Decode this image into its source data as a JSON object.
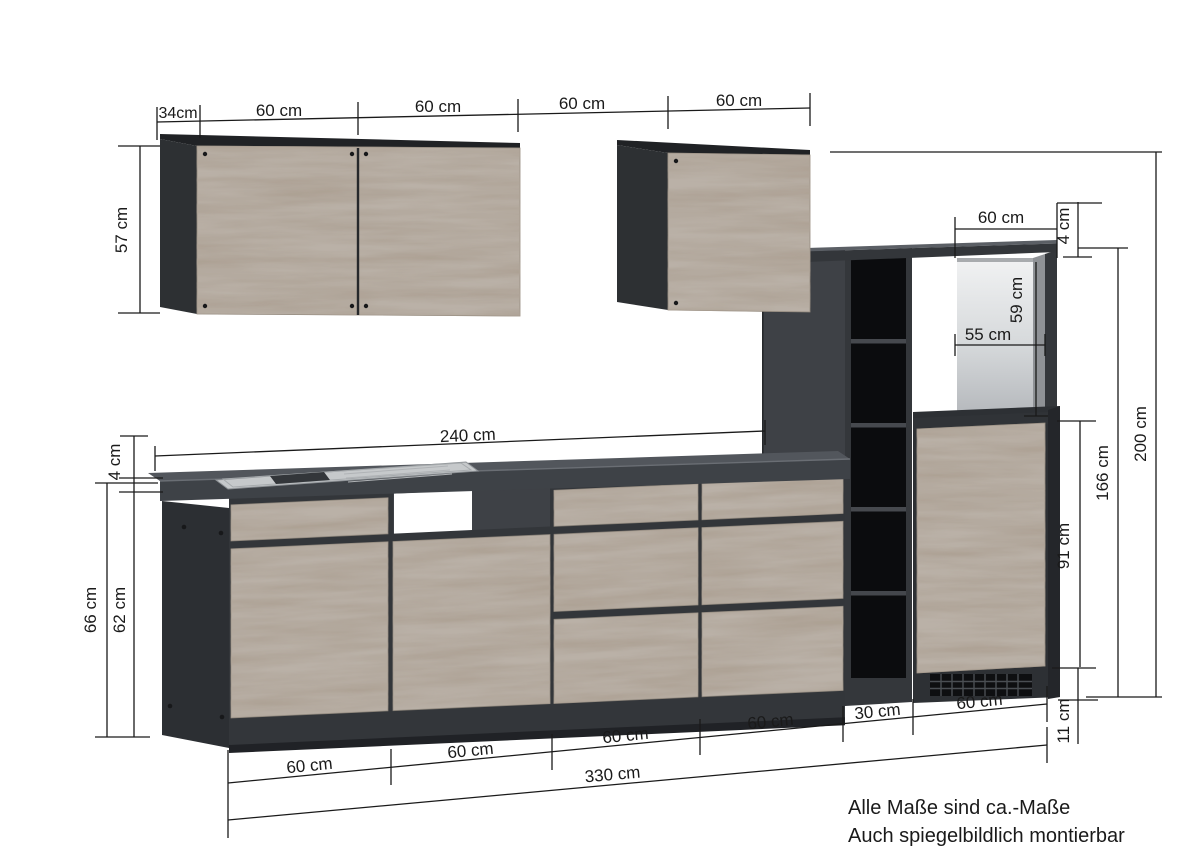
{
  "drawing": {
    "type": "kitchen-cabinet-dimension-diagram",
    "colors": {
      "background": "#ffffff",
      "wood": "#bab1a7",
      "wood_grain": "#6b5c4d",
      "carcass_dark": "#2d3033",
      "front_dark": "#3e4146",
      "counter_top": "#4f5257",
      "counter_front": "#3e4247",
      "shelf_interior": "#0b0c0e",
      "niche_light": "#eff0f1",
      "dimension_lines": "#1a1a1a"
    }
  },
  "dims": {
    "top": [
      "34cm",
      "60 cm",
      "60 cm",
      "60 cm",
      "60 cm"
    ],
    "wall_cabinet_height": "57 cm",
    "worktop_thickness": "4 cm",
    "base_total_height": "66 cm",
    "base_body_height": "62 cm",
    "run_length": "240 cm",
    "niche_width": "60 cm",
    "top_panel_thickness": "4 cm",
    "niche_height": "59 cm",
    "niche_inner_width": "55 cm",
    "tall_total_height": "200 cm",
    "tall_body_height": "166 cm",
    "tall_door_height": "91 cm",
    "plinth_height": "11 cm",
    "bottom": [
      "60 cm",
      "60 cm",
      "60 cm",
      "60 cm",
      "30 cm",
      "60 cm"
    ],
    "total_length": "330 cm"
  },
  "footer": {
    "line1": "Alle Maße sind ca.-Maße",
    "line2": "Auch spiegelbildlich montierbar"
  }
}
